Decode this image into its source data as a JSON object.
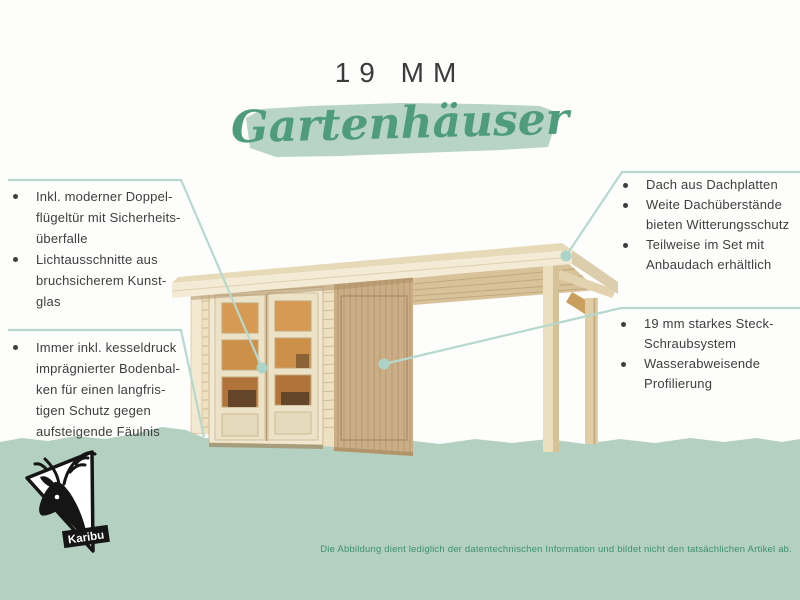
{
  "header": {
    "title": "19 MM",
    "subtitle": "Gartenhäuser"
  },
  "features_left_top": {
    "items": [
      {
        "text": "Inkl. moderner Doppel-\nflügeltür mit Sicherheits-\nüberfalle"
      },
      {
        "text": "Lichtausschnitte aus\nbruchsicherem Kunst-\nglas"
      }
    ]
  },
  "features_left_bottom": {
    "items": [
      {
        "text": "Immer inkl. kesseldruck\nimprägnierter Bodenbal-\nken für einen langfris-\ntigen Schutz gegen\naufsteigende Fäulnis"
      }
    ]
  },
  "features_right_top": {
    "items": [
      {
        "text": "Dach aus Dachplatten"
      },
      {
        "text": "Weite Dachüberstände\nbieten Witterungsschutz"
      },
      {
        "text": "Teilweise im Set mit\nAnbaudach erhältlich"
      }
    ]
  },
  "features_right_bottom": {
    "items": [
      {
        "text": "19 mm starkes Steck-\nSchraubsystem"
      },
      {
        "text": "Wasserabweisende\nProfilierung"
      }
    ]
  },
  "footer": {
    "disclaimer": "Die Abbildung dient lediglich der datentechnischen Information und bildet nicht den tatsächlichen Artikel ab."
  },
  "logo": {
    "brand": "Karibu"
  },
  "colors": {
    "accent_green": "#4f9c7d",
    "brush_green": "#b7d4c6",
    "band_green": "#b3d0c1",
    "line_teal": "#b6d8ce",
    "dot_teal": "#abd3c7",
    "text_dark": "#3e3e3e",
    "disclaimer_green": "#3e916f",
    "wood_light": "#f3ebd6",
    "wood_mid": "#cbae85",
    "glass_amber": "#cd9049"
  }
}
